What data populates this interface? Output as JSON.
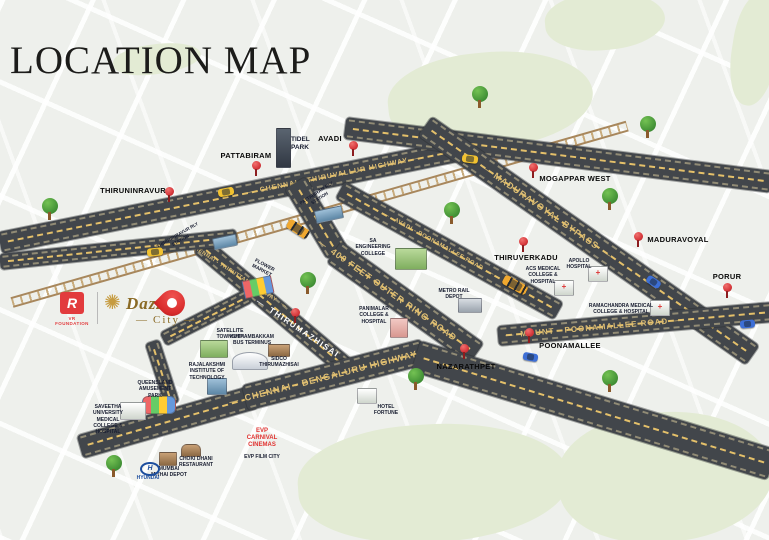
{
  "title": "LOCATION MAP",
  "branding": {
    "developer_abbr": "R",
    "developer_name": "VR FOUNDATION",
    "project_line1": "Dazzle",
    "project_line2": "City"
  },
  "roads": {
    "chennai_thiruvallur_highway": "CHENNAI - THIRUVALLUR HIGHWAY",
    "maduravoyal_bypass": "MADURAVOYAL BYPASS",
    "avadi_poonamallee_road": "AVADI - POONAMALLEE ROAD",
    "outer_ring_road": "400 FEET OUTER RING ROAD",
    "chennai_thiruttani_highway": "CHENNAI - THIRUTTANI HIGHWAY",
    "mount_poonamallee_road": "MOUNT - POONAMALLEE ROAD",
    "chennai_bengaluru_highway": "CHENNAI - BENGALURU HIGHWAY",
    "thirumazhisai_onroad": "THIRUMAZHISAI"
  },
  "towns": {
    "pattabiram": "PATTABIRAM",
    "avadi": "AVADI",
    "mogappar_west": "MOGAPPAR WEST",
    "thiruninravur": "THIRUNINRAVUR",
    "maduravoyal": "MADURAVOYAL",
    "thiruverkadu": "THIRUVERKADU",
    "porur": "PORUR",
    "poonamallee": "POONAMALLEE",
    "nazarathpet": "NAZARATHPET"
  },
  "pois": {
    "tidel_park": "TIDEL PARK",
    "pattabiram_rly_station": "PATTABIRAM RLY STATION",
    "thiruninravur_rly_station": "THIRUNINRAVUR RLY STATION",
    "engineering_college": "SA ENGINEERING COLLEGE",
    "metro_rail_depot": "METRO RAIL DEPOT",
    "panimalar": "PANIMALAR COLLEGE & HOSPITAL",
    "acs_medical": "ACS MEDICAL COLLEGE & HOSPITAL",
    "apollo_hospital": "APOLLO HOSPITAL",
    "ramachandra": "RAMACHANDRA MEDICAL COLLEGE & HOSPITAL",
    "satellite_township": "SATELLITE TOWNSHIP",
    "kuthambakkam_bus_terminus": "KUTHAMBAKKAM BUS TERMINUS",
    "rajalakshmi": "RAJALAKSHMI INSTITUTE OF TECHNOLOGY",
    "queensland": "QUEENSLAND AMUSEMENT PARK",
    "saveetha": "SAVEETHA UNIVERSITY MEDICAL COLLEGE & HOSPITAL",
    "sidco": "SIDCO THIRUMAZHISAI",
    "flower_market": "FLOWER MARKET",
    "choki_dhani": "CHOKI DHANI RESTAURANT",
    "mithai_depot": "MUMBAI MITHAI DEPOT",
    "hyundai": "HYUNDAI",
    "evp_carnival": "EVP CARNIVAL CINEMAS",
    "evp_film_city": "EVP FILM CITY",
    "hotel": "HOTEL FORTUNE"
  },
  "colors": {
    "road": "#42464b",
    "road_label_gold": "#dcbd74",
    "pin_red": "#d6373b",
    "brand_gold": "#8a6a25",
    "brand_red": "#e23b3d",
    "green_patch": "#e3ebd4"
  }
}
